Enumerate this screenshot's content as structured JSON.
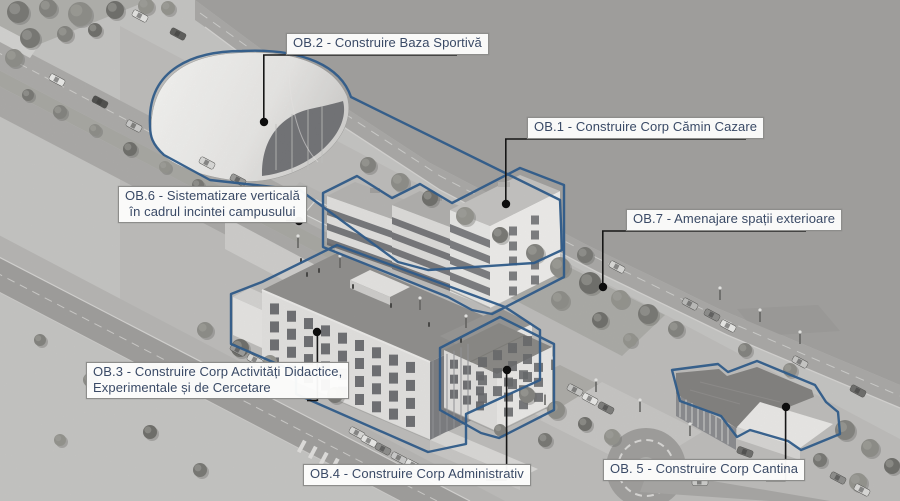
{
  "colors": {
    "outline_blue": "#1f5186",
    "label_text": "#3a4a66",
    "leader_black": "#161616"
  },
  "labels": {
    "ob1": {
      "text": "OB.1 - Construire Corp Cămin Cazare"
    },
    "ob2": {
      "text": "OB.2 - Construire Baza Sportivă"
    },
    "ob3": {
      "line1": "OB.3 - Construire Corp Activități Didactice,",
      "line2": "Experimentale și de Cercetare"
    },
    "ob4": {
      "text": "OB.4 - Construire Corp Administrativ"
    },
    "ob5": {
      "text": "OB. 5 - Construire Corp Cantina"
    },
    "ob6": {
      "line1": "OB.6 - Sistematizare verticală",
      "line2": "în cadrul incintei campusului"
    },
    "ob7": {
      "text": "OB.7 - Amenajare spații exterioare"
    }
  }
}
